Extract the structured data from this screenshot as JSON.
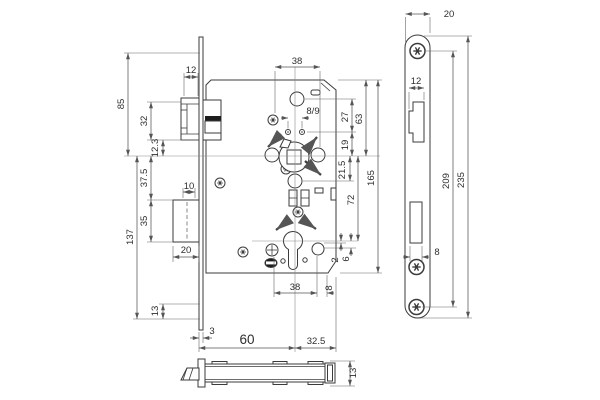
{
  "drawing": {
    "type": "technical dimension drawing of a mortise door lock",
    "colors": {
      "background": "#ffffff",
      "line": "#3b3b3b",
      "dimension": "#555555",
      "text": "#2e2e2e",
      "solid_fill": "#1d1d1d"
    }
  },
  "dims": {
    "left": {
      "d85": "85",
      "d137": "137",
      "d32": "32",
      "d12_3": "12.3",
      "d37_5": "37.5",
      "d35": "35",
      "d13": "13"
    },
    "latch_deadbolt": {
      "d12": "12",
      "d10": "10",
      "d20": "20"
    },
    "case": {
      "d38_top": "38",
      "d8_9": "8/9",
      "d27": "27",
      "d19": "19",
      "d63": "63",
      "d21_5": "21.5",
      "d72": "72",
      "d165": "165",
      "d2": "2",
      "d6": "6",
      "d38_bottom": "38",
      "d8": "8"
    },
    "bottom": {
      "d3": "3",
      "d60": "60",
      "d32_5": "32.5",
      "d13": "13"
    },
    "faceplate": {
      "d20": "20",
      "d12": "12",
      "d8": "8",
      "d209": "209",
      "d235": "235"
    }
  }
}
